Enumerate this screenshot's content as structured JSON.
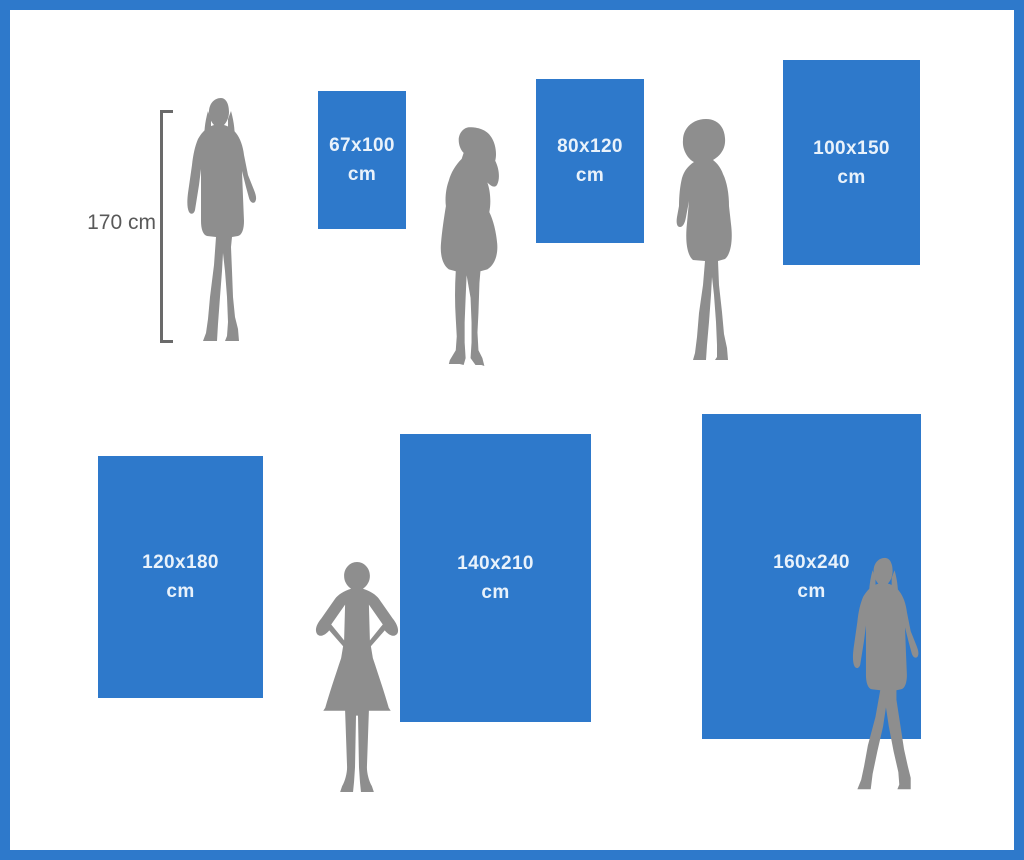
{
  "measure": {
    "label": "170 cm"
  },
  "boards": [
    {
      "size": "67x100",
      "unit": "cm"
    },
    {
      "size": "80x120",
      "unit": "cm"
    },
    {
      "size": "100x150",
      "unit": "cm"
    },
    {
      "size": "120x180",
      "unit": "cm"
    },
    {
      "size": "140x210",
      "unit": "cm"
    },
    {
      "size": "160x240",
      "unit": "cm"
    }
  ],
  "figures": [
    {
      "icon": "woman-standing-front-silhouette-icon"
    },
    {
      "icon": "woman-side-profile-silhouette-icon"
    },
    {
      "icon": "woman-curly-hair-silhouette-icon"
    },
    {
      "icon": "woman-hands-on-hips-silhouette-icon"
    },
    {
      "icon": "woman-standing-boots-silhouette-icon"
    }
  ],
  "colors": {
    "frame_blue": "#2e79cb",
    "board_blue": "#2e79cb",
    "board_text": "#e9f2fb",
    "silhouette_gray": "#8e8e8e",
    "measure_text": "#595959",
    "background": "#ffffff"
  }
}
